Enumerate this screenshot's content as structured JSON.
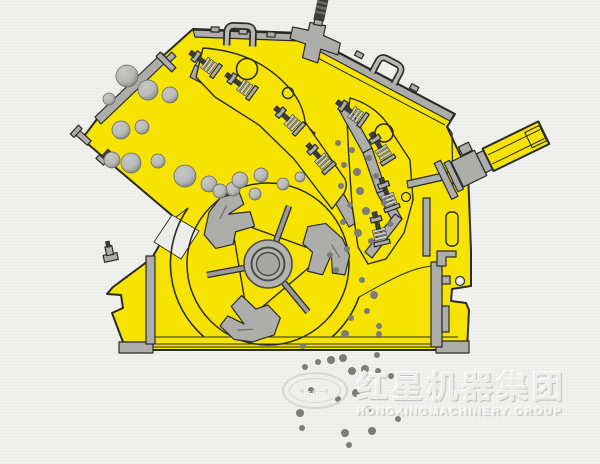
{
  "page": {
    "description": "Cross-section illustration of an impact crusher: yellow housing, feed chute with tumbling rock, two spring-loaded impact aprons, rotor with three blow bars, tension rod, base frame, and crushed material discharging below"
  },
  "colors": {
    "background": "#f1f1ef",
    "body_yellow": "#f6e400",
    "outline": "#2a2a28",
    "metal_gray": "#adadab",
    "metal_light": "#c9c9c7",
    "metal_dark": "#8a8a88",
    "bolt_dark": "#3c3c3a",
    "rock_light": "#b9b9b7",
    "rock_dark": "#757573",
    "dust": "#7c7c7a",
    "watermark": "#d6d6d4"
  },
  "watermark": {
    "logo_glyphs": "+–+–+",
    "company_cn": "红星机器集团",
    "company_en": "HONGXINGMACHINERY GROUP"
  },
  "particles": {
    "rocks": [
      [
        127,
        76,
        11
      ],
      [
        148,
        90,
        10
      ],
      [
        170,
        95,
        8
      ],
      [
        109,
        99,
        6
      ],
      [
        121,
        130,
        9
      ],
      [
        142,
        127,
        7
      ],
      [
        112,
        160,
        8
      ],
      [
        131,
        163,
        10
      ],
      [
        158,
        161,
        7
      ],
      [
        185,
        176,
        11
      ],
      [
        209,
        184,
        8
      ],
      [
        233,
        189,
        7
      ],
      [
        240,
        180,
        8
      ],
      [
        261,
        175,
        7
      ],
      [
        283,
        184,
        6
      ],
      [
        300,
        177,
        5
      ],
      [
        255,
        194,
        6
      ],
      [
        220,
        191,
        7
      ]
    ],
    "interior_dust": [
      [
        352,
        150,
        3
      ],
      [
        344,
        165,
        3
      ],
      [
        357,
        172,
        4
      ],
      [
        341,
        186,
        3
      ],
      [
        360,
        191,
        4
      ],
      [
        350,
        205,
        3
      ],
      [
        366,
        211,
        4
      ],
      [
        343,
        222,
        3
      ],
      [
        358,
        233,
        4
      ],
      [
        371,
        241,
        3
      ],
      [
        347,
        249,
        3
      ],
      [
        338,
        143,
        3
      ],
      [
        369,
        158,
        3
      ],
      [
        376,
        176,
        3
      ],
      [
        384,
        203,
        3
      ],
      [
        390,
        224,
        3
      ],
      [
        362,
        280,
        3
      ],
      [
        374,
        295,
        4
      ],
      [
        367,
        311,
        3
      ],
      [
        379,
        326,
        3
      ],
      [
        351,
        318,
        3
      ],
      [
        345,
        334,
        4
      ],
      [
        379,
        334,
        3
      ],
      [
        303,
        346,
        3
      ],
      [
        330,
        255,
        3
      ],
      [
        336,
        270,
        3
      ]
    ],
    "falling_dust": [
      [
        305,
        367,
        3
      ],
      [
        318,
        362,
        3
      ],
      [
        331,
        360,
        4
      ],
      [
        343,
        358,
        4
      ],
      [
        352,
        371,
        4
      ],
      [
        365,
        369,
        4
      ],
      [
        378,
        371,
        3
      ],
      [
        377,
        355,
        3
      ],
      [
        391,
        376,
        3
      ],
      [
        311,
        390,
        3
      ],
      [
        356,
        393,
        4
      ],
      [
        338,
        399,
        3
      ],
      [
        369,
        409,
        3
      ],
      [
        300,
        413,
        4
      ],
      [
        345,
        433,
        4
      ],
      [
        372,
        431,
        4
      ],
      [
        398,
        419,
        3
      ],
      [
        302,
        428,
        3
      ],
      [
        349,
        445,
        3
      ]
    ]
  }
}
